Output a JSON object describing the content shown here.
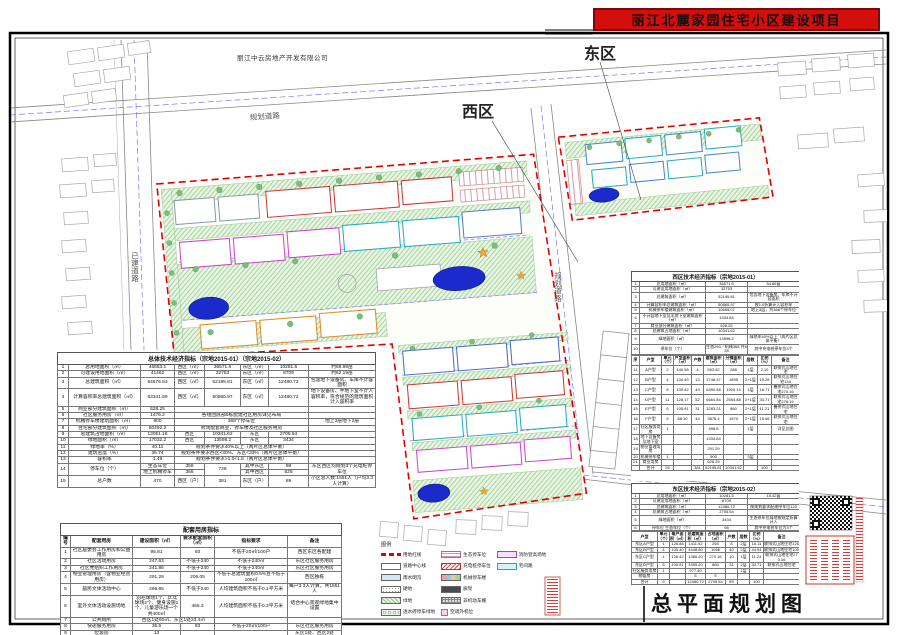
{
  "window": {
    "title": "丽江北麓家园住宅小区建设项目"
  },
  "map": {
    "company": "丽江中云房地产开发有限公司",
    "west_label": "西区",
    "east_label": "东区",
    "road_planned": "规划道路",
    "road_planned_v": "规划道路",
    "road_existing": "已建道路",
    "plan_title": "总平面规划图",
    "legend_title": "图例"
  },
  "legend": {
    "items": [
      {
        "label": "用地红线"
      },
      {
        "label": "道路中心线"
      },
      {
        "label": "雨水明沟"
      },
      {
        "label": "硬地"
      },
      {
        "label": "绿地"
      },
      {
        "label": "透水砖停车绿地"
      },
      {
        "label": "生态停车位"
      },
      {
        "label": "充电桩停车位"
      },
      {
        "label": "机械停车楼"
      },
      {
        "label": "廊架"
      },
      {
        "label": "非机动车棚"
      },
      {
        "label": "空调外机位"
      },
      {
        "label": "消防登高场地"
      },
      {
        "label": "宅间路"
      }
    ]
  },
  "overall_table": {
    "title": "总体技术经济指标（宗地2015-01）（宗地2015-02）",
    "rows": [
      [
        "1",
        "总用地面积（㎡）",
        "46653.1",
        "西区（㎡）",
        "36571.6",
        "东区（㎡）",
        "10281.5",
        "约69.98亩"
      ],
      [
        "2",
        "可建设用地面积（㎡）",
        "41462",
        "西区（㎡）",
        "32753",
        "东区（㎡）",
        "8709",
        "约62.19亩"
      ],
      [
        "3",
        "总建筑面积（㎡）",
        "64676.53",
        "西区（㎡）",
        "52195.81",
        "东区（㎡）",
        "12480.72",
        "包含地下设备房、车库不计容面积"
      ],
      [
        "4",
        "计算容积率总建筑面积（㎡）",
        "63341.69",
        "西区（㎡）",
        "50860.97",
        "东区（㎡）",
        "12480.72",
        "地下设备房、半地下室不计入容积率，符合规范的建筑面积计入容积率"
      ],
      [
        "5",
        "商业部分建筑面积（㎡）",
        "628.25",
        {
          "t": "",
          "c": 4
        },
        ""
      ],
      [
        "6",
        "社区服务用房（㎡）",
        "1476.2",
        {
          "t": "各组团底部5栋配建社区用房详见布局",
          "c": 4
        },
        ""
      ],
      [
        "7",
        "机械停车楼建筑面积（㎡）",
        "900",
        {
          "t": "368个停车位",
          "c": 4
        },
        "地上3层地下2层"
      ],
      [
        "8",
        "住宅部分建筑面积（㎡）",
        "60492.2",
        {
          "t": "封闭配套商业、停车楼及社区服务用房",
          "c": 4
        },
        ""
      ],
      [
        "9",
        "总建筑占地面积（㎡）",
        "13051.16",
        "西区",
        "10341.62",
        "东区",
        "2705.54",
        ""
      ],
      [
        "10",
        "绿地面积（㎡）",
        "17032.2",
        "西区",
        "13598.2",
        "东区",
        "3434",
        ""
      ],
      [
        "11",
        "绿地率（%）",
        "40.11",
        {
          "t": "规划条件要求40%以上（两片区总体平衡）",
          "c": 4
        },
        ""
      ],
      [
        "12",
        "建筑密度（%）",
        "36.74",
        {
          "t": "规划条件要求西区<30%、东区<33%（两片区总体平衡）",
          "c": 4
        },
        ""
      ],
      [
        "13",
        "容积率",
        "1.49",
        {
          "t": "规划条件要求>1.0<1.5（两片区总体平衡）",
          "c": 4
        },
        ""
      ],
      [
        {
          "t": "14",
          "r": 2
        },
        {
          "t": "停车位（个）",
          "r": 2
        },
        "生态车位",
        "358",
        {
          "t": "726",
          "r": 2
        },
        "其中东区",
        "98",
        {
          "t": "东区西区均规划3个充电桩停车位",
          "r": 2
        }
      ],
      [
        "地上机械停车",
        "368",
        "其中西区",
        "628"
      ],
      [
        "15",
        "总户数",
        "470",
        "西区（户）",
        "381",
        "东区（户）",
        "89",
        "小区总人数:1551人（户均3.3人计算）"
      ]
    ]
  },
  "support_table": {
    "title": "配套用房指标",
    "rows": [
      [
        {
          "t": "编号",
          "s": "b"
        },
        {
          "t": "配套用房",
          "s": "b"
        },
        {
          "t": "建设面积（㎡）",
          "s": "b"
        },
        {
          "t": "要求配套面积（㎡）",
          "s": "b"
        },
        {
          "t": "指标要求",
          "s": "b"
        },
        {
          "t": "备注",
          "s": "b"
        }
      ],
      [
        "1",
        "社区居委会工作用房和公益用房",
        "95.81",
        "93",
        "不低于20㎡/100户",
        "西区东区各配建"
      ],
      [
        "2",
        "社区活动用房",
        "247.63",
        "不低于240",
        "不低于240㎡",
        "东区社区服务用房"
      ],
      [
        "3",
        "社区党组织工作用房",
        "241.86",
        "不低于240",
        "不低于240㎡",
        "东区社区服务用房"
      ],
      [
        "4",
        "物业管理用房（含物业经营用房）",
        "291.29",
        "206.05",
        "不低于总建筑面积0.5%且不低于100㎡",
        "西区独栋"
      ],
      [
        "5",
        "居民文体活动中心",
        "296.65",
        "不低于240",
        "人均建筑面积不低于0.1平方米",
        "每户3.3人计算，共1551人"
      ],
      [
        "6",
        "室外文体活动设施场地",
        "羽毛球场1个、乒乓球场2个、健身设施1个、儿童游乐场一个共400㎡",
        "465.3",
        "人均建筑面积不低于0.3平方米",
        "结合中心景观绿地集中设置"
      ],
      [
        "7",
        "公共厕所",
        {
          "t": "西区1处60㎡、东区1处23.4㎡",
          "c": 2
        },
        "",
        ""
      ],
      [
        "8",
        "快递服务用房",
        "36.5",
        "93",
        "不低于20㎡/100户",
        "东区社区服务用房"
      ],
      [
        "9",
        "垃圾房",
        "13",
        "",
        "",
        "东区1处、西区2处"
      ]
    ]
  },
  "west_table": {
    "title": "西区技术经济指标（宗地2015-01）",
    "summary": [
      [
        "1",
        "总用地面积（㎡）",
        "36571.6",
        "54.86亩"
      ],
      [
        "2",
        "可建设用地面积（㎡）",
        "32753",
        ""
      ],
      [
        "3",
        "总建筑面积（㎡）",
        "52195.81",
        "包含地下设备房、车库不计容面积"
      ],
      [
        "4",
        "计算容积率总建筑面积（㎡）",
        "50860.97",
        "按1.0折算计入容积率"
      ],
      [
        "5",
        "机械停车楼建筑面积（㎡）",
        "10665.07",
        "地上3层，共368个停车位"
      ],
      [
        "6",
        "不计容地下室及半地下室建筑面积（㎡）",
        "1334.84",
        ""
      ],
      [
        "7",
        "商业部分建筑面积（㎡）",
        "628.25",
        ""
      ],
      [
        "8",
        "总建筑占地面积（㎡）",
        "10341.62",
        ""
      ],
      [
        "9",
        "绿地面积（㎡）",
        "13598.2",
        "绿地率40%以上（两片区总体平衡）"
      ],
      [
        "10",
        "停车位（个）",
        "生态260／机械368 共628",
        "其中充电桩停车位3个"
      ]
    ],
    "units": [
      [
        {
          "t": "序",
          "s": "b"
        },
        {
          "t": "户型",
          "s": "b"
        },
        {
          "t": "单元（个）",
          "s": "b"
        },
        {
          "t": "户型面积（㎡）",
          "s": "b"
        },
        {
          "t": "户数",
          "s": "b"
        },
        {
          "t": "建筑面积（㎡）",
          "s": "b"
        },
        {
          "t": "分摊面积（㎡）",
          "s": "b"
        },
        {
          "t": "层数",
          "s": "b"
        },
        {
          "t": "比例（%）",
          "s": "b"
        },
        {
          "t": "备注",
          "s": "b"
        }
      ],
      [
        "11",
        "A户型",
        "2",
        "140.98",
        "4",
        "563.92",
        "288",
        "1层",
        "2.10",
        "联排式山地住宅"
      ],
      [
        "12",
        "B户型",
        "4",
        "134.49",
        "13",
        "1748.37",
        "1895",
        "2+1层",
        "15.28",
        "联排式山地住宅134"
      ],
      [
        "13",
        "C户型",
        "8",
        "130.42",
        "49",
        "6390.58",
        "1920.14",
        "1层",
        "16.71",
        "叠拼式山地住宅270.16"
      ],
      [
        "14",
        "D户型",
        "11",
        "128.17",
        "52",
        "6664.84",
        "2554.88",
        "2+1层",
        "33.71",
        "联排式山地住宅278.19"
      ],
      [
        "15",
        "E户型",
        "6",
        "105.91",
        "31",
        "3283.21",
        "880",
        "2+1层",
        "11.21",
        "叠拼式山地住宅"
      ],
      [
        "16",
        "F户型",
        "5",
        "88.10",
        "44",
        "3876.4",
        "1570",
        "2+1层",
        "15.46",
        "联排式山地住宅"
      ],
      [
        "17",
        "社区服务用房",
        "1",
        "",
        "",
        "498.8",
        "",
        "1层",
        "",
        "详见总图"
      ],
      [
        "18",
        "地下设备房及地下室",
        "",
        "",
        "",
        "1334.84",
        "",
        "",
        "",
        ""
      ],
      [
        "19",
        "物业管理用房",
        "",
        "",
        "",
        "291.29",
        "",
        "",
        "",
        ""
      ],
      [
        "20",
        "机械停车楼",
        "1",
        "",
        "",
        "900",
        "",
        "3层",
        "",
        ""
      ],
      [
        "21",
        "商业用房",
        "",
        "",
        "",
        "628.25",
        "",
        "",
        "",
        ""
      ],
      [
        "",
        "合计",
        "26",
        "",
        "381",
        "52195.81",
        "10341.62",
        "",
        "100",
        ""
      ]
    ]
  },
  "east_table": {
    "title": "东区技术经济指标（宗地2015-02）",
    "summary": [
      [
        "1",
        "总用地面积（㎡）",
        "10281.5",
        "15.42亩"
      ],
      [
        "2",
        "可建设用地面积（㎡）",
        "8709",
        ""
      ],
      [
        "3",
        "总建筑面积（㎡）",
        "12480.72",
        "按规划要求配建停车位125"
      ],
      [
        "4",
        "总建筑占地面积（㎡）",
        "2705.54",
        ""
      ],
      [
        "5",
        "绿地面积（㎡）",
        "3434",
        "生态停车位绿地按规定折算计入"
      ],
      [
        "6",
        "停车位 生态车位（个）",
        "98",
        "其中充电桩车位为3个"
      ]
    ],
    "units": [
      [
        {
          "t": "户型",
          "s": "b"
        },
        {
          "t": "单元（个）",
          "s": "b"
        },
        {
          "t": "每户面积（㎡）",
          "s": "b"
        },
        {
          "t": "总建筑面积（㎡）",
          "s": "b"
        },
        {
          "t": "占地面积（㎡）",
          "s": "b"
        },
        {
          "t": "户数",
          "s": "b"
        },
        {
          "t": "层数",
          "s": "b"
        },
        {
          "t": "比例（%）",
          "s": "b"
        },
        {
          "t": "备注",
          "s": "b"
        }
      ],
      [
        "东区A户型",
        "1",
        "126.88",
        "1411.52",
        "265",
        "8",
        "2层",
        "16.11",
        "联排式山地住宅126"
      ],
      [
        "东区B户型",
        "4",
        "105.40",
        "4448.80",
        "1056",
        "40",
        "2层",
        "44.94",
        "联排式山地住宅105"
      ],
      [
        "东区C户型",
        "1",
        "126.42",
        "1366.20",
        "270.16",
        "10",
        "1层",
        "11.24",
        "联排式山地住宅270.16"
      ],
      [
        "东区D户型",
        "5",
        "105.91",
        "3395.20",
        "880",
        "31",
        "2层",
        "33.71",
        "联排式山地住宅"
      ],
      [
        "社区服务用房",
        "1",
        "",
        "977.40",
        "",
        "",
        "1层",
        "",
        ""
      ],
      [
        "物管房",
        "",
        "",
        "5",
        "5",
        "",
        "",
        "",
        ""
      ],
      [
        "合计",
        "9",
        "",
        "12480.72",
        "2705.54",
        "89",
        "",
        "100",
        ""
      ]
    ]
  }
}
